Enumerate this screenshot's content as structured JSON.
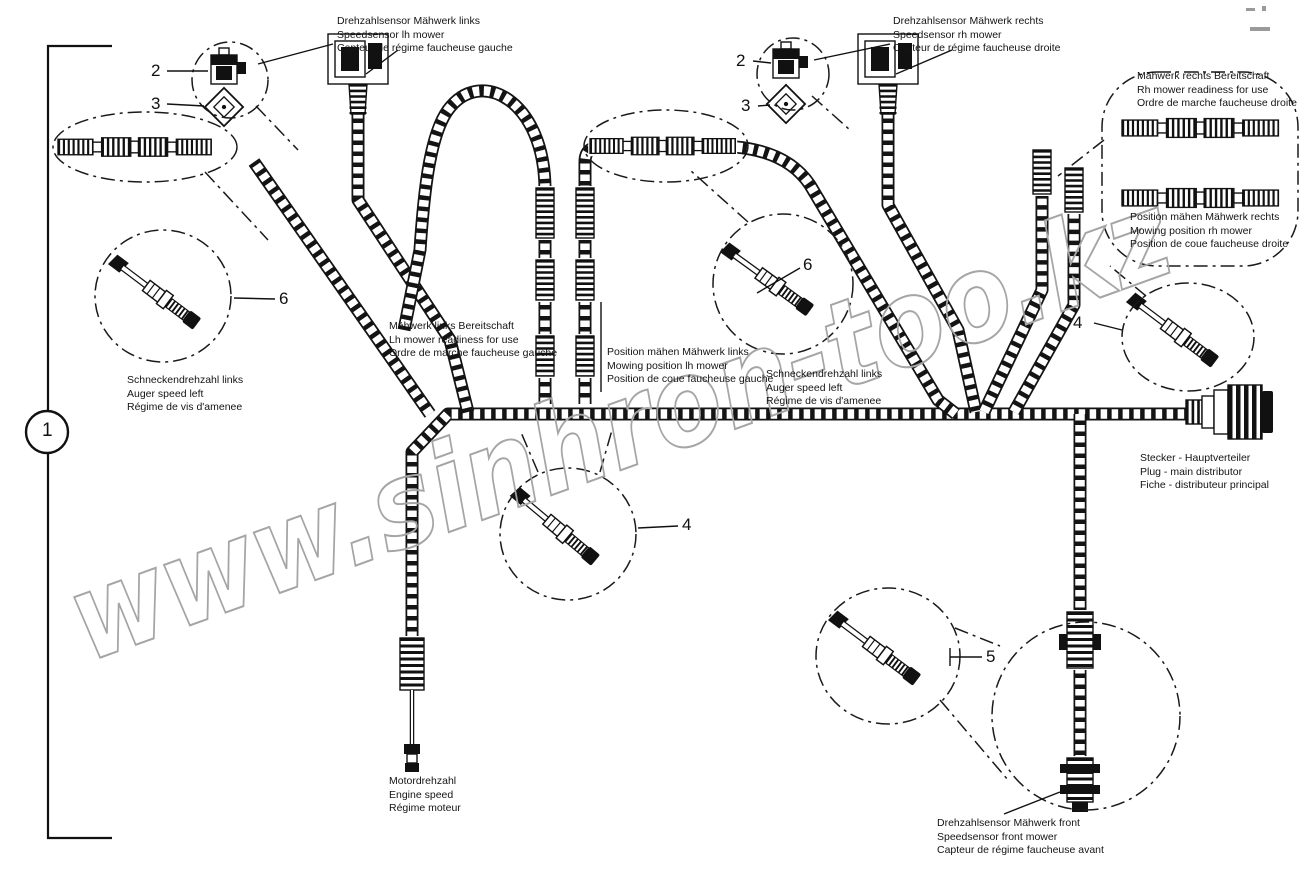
{
  "watermark": {
    "text": "www.sinhron-too.kz",
    "color": "#a5a5a5"
  },
  "callouts": {
    "n1": "1",
    "n2": "2",
    "n3": "3",
    "n4": "4",
    "n5": "5",
    "n6": "6"
  },
  "labels": {
    "drehzahl_links": {
      "l1": "Drehzahlsensor Mähwerk links",
      "l2": "Speedsensor lh mower",
      "l3": "Capteur de régime faucheuse gauche"
    },
    "drehzahl_rechts": {
      "l1": "Drehzahlsensor Mähwerk rechts",
      "l2": "Speedsensor rh mower",
      "l3": "Capteur de régime faucheuse droite"
    },
    "bereit_rechts": {
      "l1": "Mähwerk rechts Bereitschaft",
      "l2": "Rh mower readiness for use",
      "l3": "Ordre de marche faucheuse droite"
    },
    "position_rechts": {
      "l1": "Position mähen Mähwerk rechts",
      "l2": "Mowing position rh mower",
      "l3": "Position de coue faucheuse droite"
    },
    "bereit_links": {
      "l1": "Mähwerk links Bereitschaft",
      "l2": "Lh mower readiness for use",
      "l3": "Ordre de marche faucheuse gauche"
    },
    "position_links": {
      "l1": "Position mähen Mähwerk links",
      "l2": "Mowing position lh mower",
      "l3": "Position de coue faucheuse gauche"
    },
    "schnecke_links": {
      "l1": "Schneckendrehzahl links",
      "l2": "Auger speed left",
      "l3": "Régime de vis d'amenee"
    },
    "schnecke_rechts": {
      "l1": "Schneckendrehzahl links",
      "l2": "Auger speed left",
      "l3": "Régime de vis d'amenee"
    },
    "stecker": {
      "l1": "Stecker - Hauptverteiler",
      "l2": "Plug - main distributor",
      "l3": "Fiche - distributeur principal"
    },
    "motor": {
      "l1": "Motordrehzahl",
      "l2": "Engine speed",
      "l3": "Régime moteur"
    },
    "front": {
      "l1": "Drehzahlsensor Mähwerk front",
      "l2": "Speedsensor front mower",
      "l3": "Capteur de régime faucheuse avant"
    }
  }
}
